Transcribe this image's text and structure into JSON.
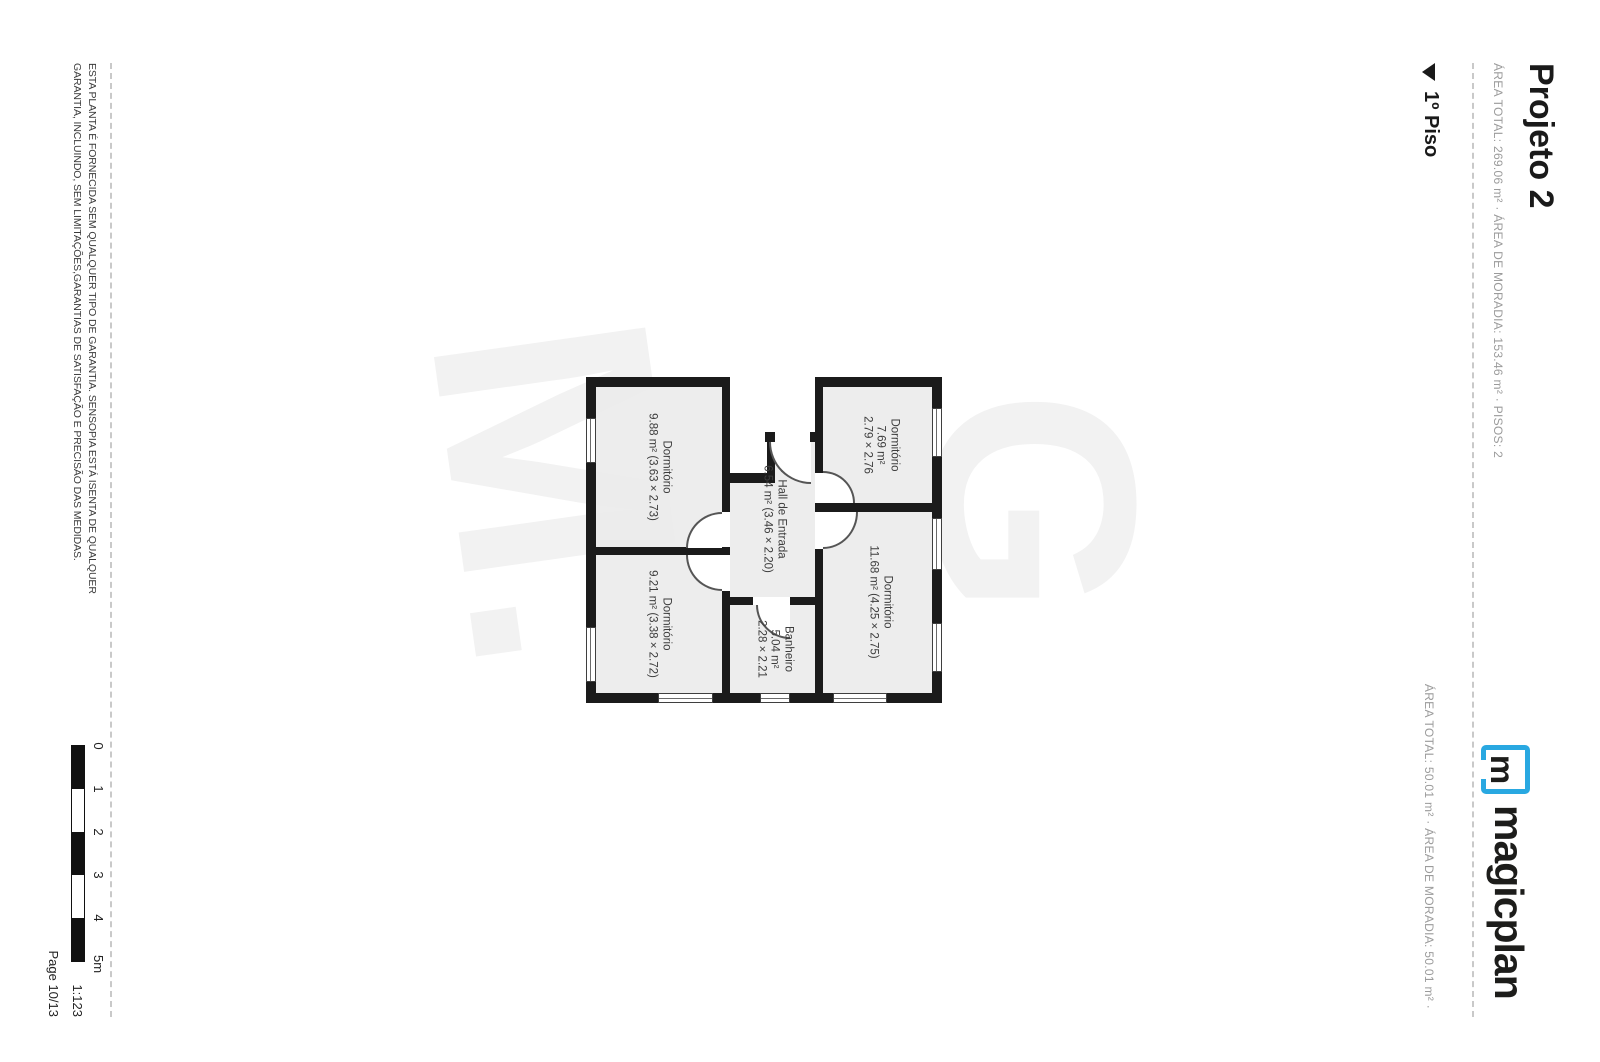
{
  "page": {
    "header": {
      "title": "Projeto 2",
      "subtitle": "ÁREA TOTAL: 269.06 m² · ÁREA DE MORADIA: 153.46 m² · PISOS: 2"
    },
    "logo": {
      "brand_color": "#29a8e1",
      "icon_letter": "m",
      "wordmark": "magicplan"
    },
    "floor_section": {
      "marker_icon": "triangle-down",
      "label": "1º Piso",
      "summary": "ÁREA TOTAL: 50.01 m² · ÁREA DE MORADIA: 50.01 m² ·"
    },
    "floor_plan": {
      "watermark_top": "G",
      "watermark_bottom": "M.",
      "rooms": [
        {
          "id": "dormitorio-1",
          "line1": "Dormitório",
          "line2": "7.69 m²",
          "line3": "2.79 × 2.76"
        },
        {
          "id": "dormitorio-2",
          "line1": "Dormitório",
          "line2": "11.68 m² (4.25 × 2.75)",
          "line3": ""
        },
        {
          "id": "hall-de-entrada",
          "line1": "Hall de Entrada",
          "line2": "6.54 m² (3.46 × 2.20)",
          "line3": ""
        },
        {
          "id": "banheiro",
          "line1": "Banheiro",
          "line2": "5.04 m²",
          "line3": "2.28 × 2.21"
        },
        {
          "id": "dormitorio-3",
          "line1": "Dormitório",
          "line2": "9.88 m² (3.63 × 2.73)",
          "line3": ""
        },
        {
          "id": "dormitorio-4",
          "line1": "Dormitório",
          "line2": "9.21 m² (3.38 × 2.72)",
          "line3": ""
        }
      ]
    },
    "footer": {
      "disclaimer_line1": "ESTA PLANTA É FORNECIDA SEM QUALQUER TIPO DE GARANTIA. SENSOPIA ESTÁ ISENTA DE QUALQUER",
      "disclaimer_line2": "GARANTIA, INCLUINDO, SEM LIMITAÇÕES,GARANTIAS DE SATISFAÇÃO E PRECISÃO DAS MEDIDAS.",
      "scale_labels": [
        "0",
        "1",
        "2",
        "3",
        "4",
        "5m"
      ],
      "scale_ratio": "1:123",
      "page_label": "Page 10/13"
    }
  }
}
